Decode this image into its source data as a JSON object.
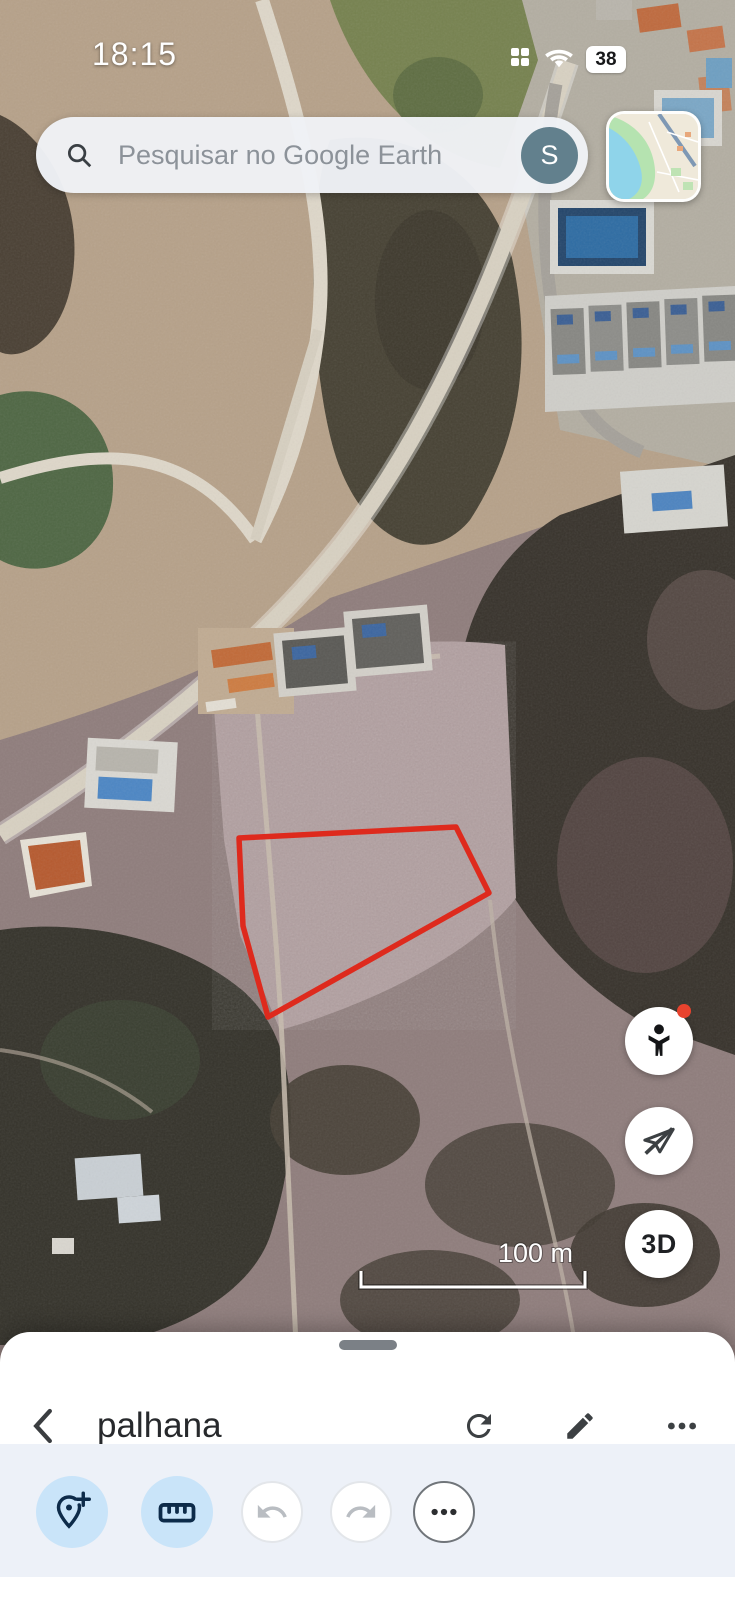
{
  "status_bar": {
    "time": "18:15",
    "battery_percent": "38",
    "icons": [
      "app-grid",
      "wifi",
      "battery"
    ]
  },
  "search": {
    "placeholder": "Pesquisar no Google Earth",
    "avatar_letter": "S"
  },
  "map": {
    "scale_label": "100 m",
    "parcel_polygon": {
      "points": "239,838 456,827 489,893 268,1017 243,926",
      "stroke_color": "#de2a1d"
    },
    "fab_3d_label": "3D",
    "pegman_badge_color": "#e8432e"
  },
  "bottom_sheet": {
    "title": "palhana",
    "actions": [
      "refresh",
      "edit",
      "overflow-menu"
    ],
    "toolbar": {
      "active_bg": "#c9e4f9",
      "icon_color": "#0d2b4a",
      "buttons": [
        "add-placemark",
        "measure",
        "undo",
        "redo",
        "more-tools"
      ],
      "disabled": [
        "undo",
        "redo"
      ]
    }
  }
}
